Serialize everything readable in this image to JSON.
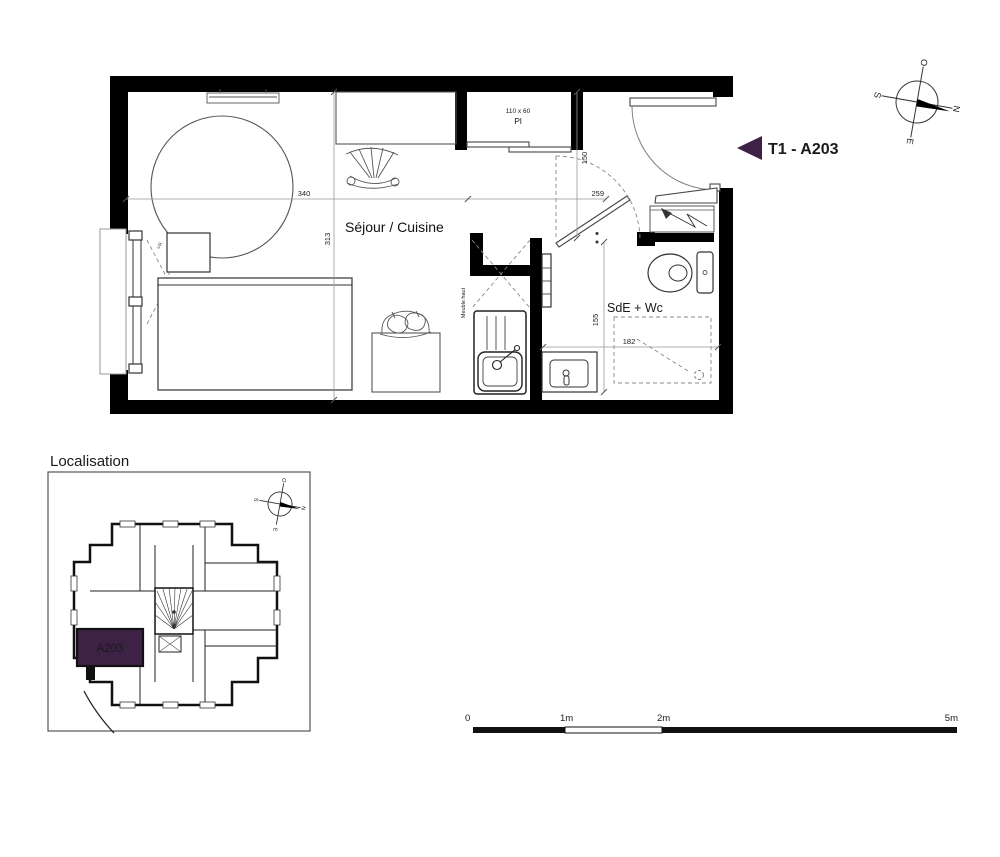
{
  "colors": {
    "accent_purple": "#3d2246",
    "wall_black": "#000000",
    "line_gray": "#555555"
  },
  "floor_plan": {
    "unit_arrow_label": "T1 - A203",
    "room_labels": {
      "living": "Séjour / Cuisine",
      "bathroom": "SdE + Wc"
    },
    "closet": {
      "dimensions": "110 x 60",
      "label": "Pl"
    },
    "annotations": {
      "upper_cabinet": "Meuble haut",
      "roller_shutter": "VR",
      "window_note": "FAp +90"
    },
    "dimensions_cm": {
      "living_width": "340",
      "living_depth": "313",
      "entry_width": "259",
      "entry_depth": "150",
      "bath_depth": "155",
      "shower_width": "182"
    }
  },
  "compass": {
    "north": "N",
    "south": "S",
    "east": "E",
    "west": "O"
  },
  "localisation": {
    "title": "Localisation",
    "highlighted_unit": "A203"
  },
  "scale_bar": {
    "labels": [
      "0",
      "1m",
      "2m",
      "5m"
    ]
  }
}
